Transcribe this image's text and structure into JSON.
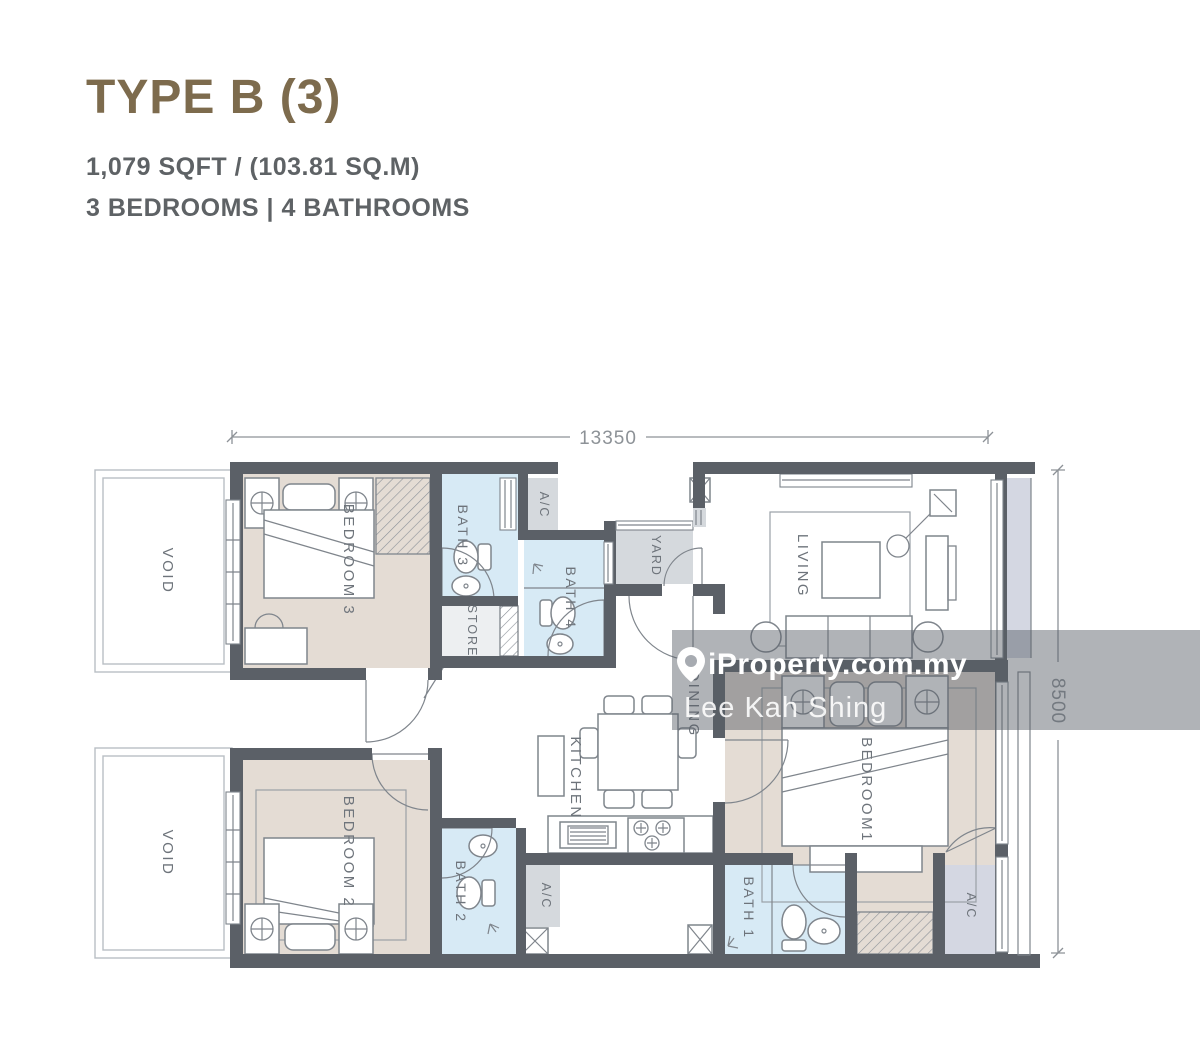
{
  "header": {
    "title": "TYPE B (3)",
    "area": "1,079 SQFT / (103.81 SQ.M)",
    "rooms": "3 BEDROOMS | 4 BATHROOMS"
  },
  "dimensions": {
    "width": "13350",
    "depth": "8500"
  },
  "watermark": {
    "brand": "iProperty.com.my",
    "agent": "Lee Kah Shing",
    "icon": "location-pin-icon"
  },
  "labels": {
    "bedroom1": "BEDROOM1",
    "bedroom2": "BEDROOM 2",
    "bedroom3": "BEDROOM 3",
    "bath1": "BATH 1",
    "bath2": "BATH 2",
    "bath3": "BATH 3",
    "bath4": "BATH 4",
    "living": "LIVING",
    "dining": "DINING",
    "kitchen": "KITCHEN",
    "yard": "YARD",
    "store": "STORE",
    "ac": "A/C",
    "void": "VOID"
  },
  "colors": {
    "title": "#7d6b4d",
    "subtitle": "#5e6265",
    "wall": "#5b6067",
    "line": "#7f858c",
    "beige": "#e4dcd4",
    "blue": "#d7eaf5",
    "gray": "#d5d9dd",
    "lavender": "#d4d7e2",
    "store": "#edeff1",
    "label": "#6e747b",
    "dim": "#8d9297",
    "wm": "rgba(88,93,101,0.47)"
  }
}
